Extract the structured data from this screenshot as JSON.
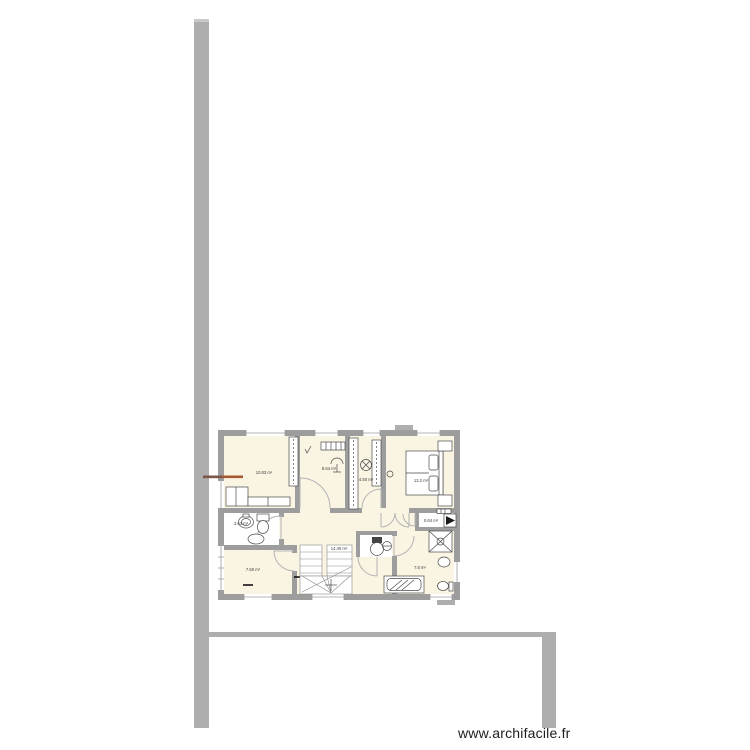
{
  "watermark": {
    "text": "www.archifacile.fr"
  },
  "plan": {
    "tool": "archifacile floor plan",
    "rooms": [
      {
        "id": "bedroom-top-left",
        "area_label": "10.83 m²"
      },
      {
        "id": "office-top-middle",
        "area_label": "8.64 m²"
      },
      {
        "id": "dressing",
        "area_label": "4.50 m²"
      },
      {
        "id": "bedroom-top-right",
        "area_label": "13.2 m²"
      },
      {
        "id": "bathroom-small",
        "area_label": "3.63 m²"
      },
      {
        "id": "hallway",
        "area_label": "14.40 m²"
      },
      {
        "id": "room-bottom-left",
        "area_label": "7.50 m²"
      },
      {
        "id": "bathroom-main",
        "area_label": "7.6 m²"
      },
      {
        "id": "closet",
        "area_label": "0.64 m²"
      }
    ],
    "colors": {
      "wall": "#9d9d9d",
      "boundary": "#aeaeae",
      "room_fill": "#faf4e3",
      "marker_orange": "#a8572e",
      "marker_brown": "#7d564a"
    }
  }
}
